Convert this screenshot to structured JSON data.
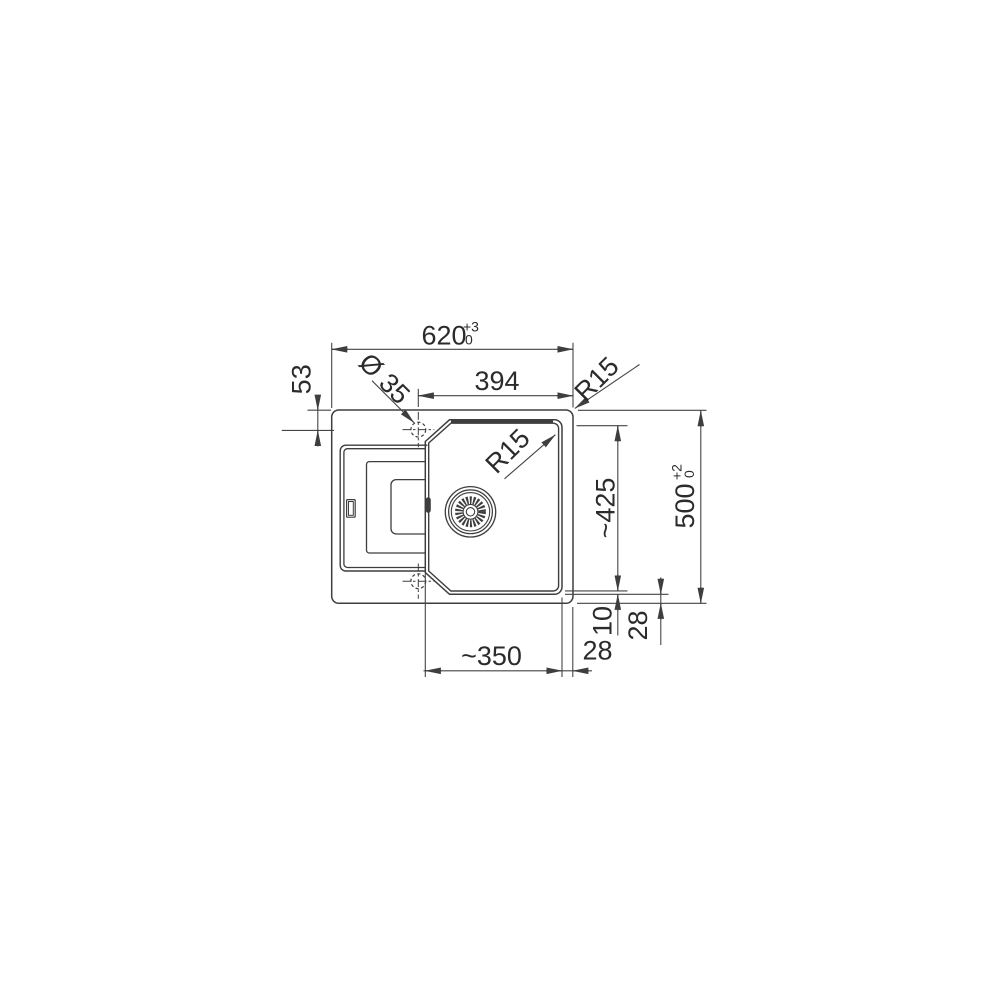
{
  "page": {
    "background": "#ffffff",
    "line_color": "#3e3e3e",
    "text_color": "#2b2b2b"
  },
  "dimensions": {
    "overall_width": {
      "value": "620",
      "tol_plus": "+3",
      "tol_minus": "0"
    },
    "hole_to_edge_width": "394",
    "tap_hole_diameter": "Ø 35",
    "tap_hole_offset": "53",
    "cutout_corner_radius": "R15",
    "bowl_corner_radius": "R15",
    "bowl_length": "~425",
    "overall_depth": {
      "value": "500",
      "tol_plus": "+2",
      "tol_minus": "0"
    },
    "rim_width": "10",
    "right_edge_gap": "28",
    "bottom_edge_gap": "28",
    "bowl_width": "~350"
  }
}
